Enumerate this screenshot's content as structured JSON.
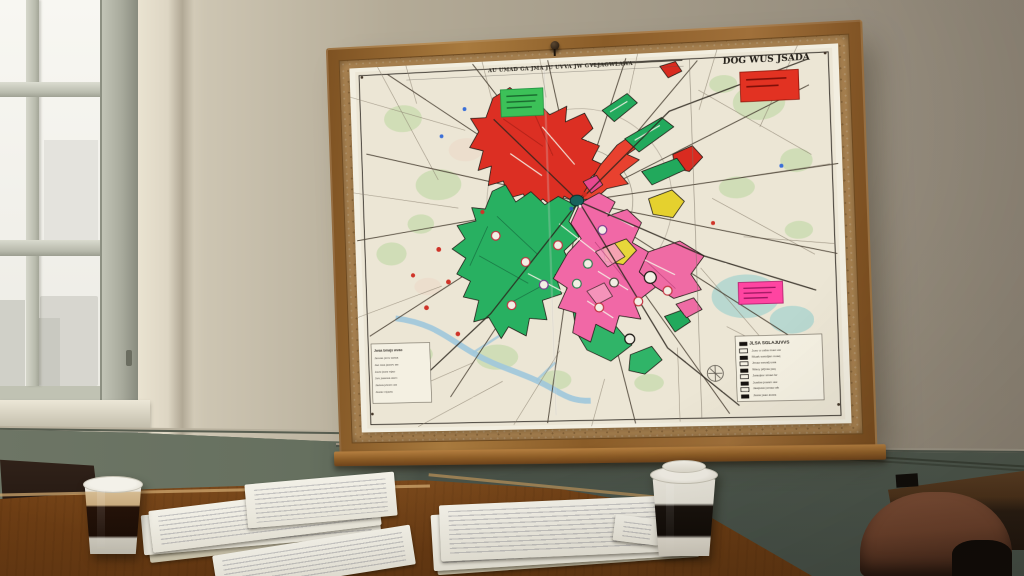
{
  "map": {
    "top_caption": "AU UMAD GA JMA JU UVVA JW GVLJAGWLAWA",
    "title_right": "DOG WUS JSADA",
    "colors": {
      "red": "#dc2f23",
      "red2": "#e8412f",
      "red3": "#d92b20",
      "green": "#28b061",
      "green2": "#30b468",
      "green3": "#22a95c",
      "pink": "#f168a6",
      "pink2": "#ef6ba4",
      "pink3": "#f79ec0",
      "magenta": "#e8488f",
      "yellow": "#e5d12e",
      "yellow2": "#e7d63a",
      "teal_center": "#17635d",
      "note_green": "#3cc158",
      "note_red": "#e23222",
      "note_pink": "#ff44a1",
      "water": "#9fc7db",
      "park": "#ccdcb2"
    },
    "legend": {
      "title": "JLSA SGLAJUVVS",
      "rows": [
        "Jusv o usba mao uw",
        "Muak swodjan nuaq",
        "Jmao swvalj uwa",
        "Wavy jsfjmw jwq",
        "Jwaojwv smao lw",
        "Juwbw jswsm aw",
        "Jawjssw jsmao wk",
        "Jsww jsao avwa"
      ]
    },
    "mini_legend": {
      "title": "Jwsa bmajs wvao",
      "rows": [
        "Javvas jsmv awwa",
        "Jao swa jawwv aw",
        "Javw jswa mjao",
        "Jwv jsawwa awm",
        "Jaowa jvwsm aw",
        "Jswav mjaow"
      ]
    }
  }
}
